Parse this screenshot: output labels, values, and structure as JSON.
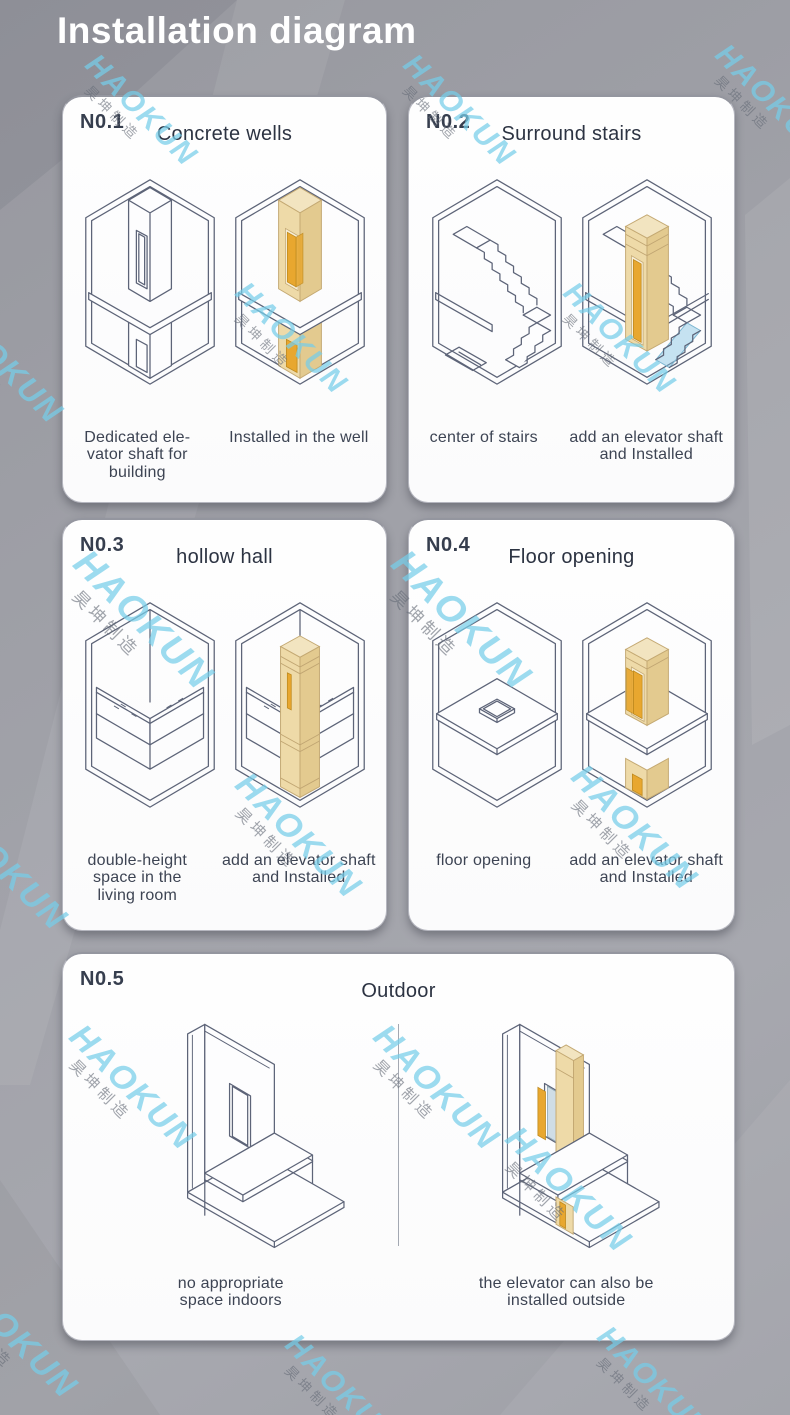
{
  "page": {
    "header_title": "Installation diagram"
  },
  "watermark": {
    "brand": "HAOKUN",
    "cn": "昊坤制造"
  },
  "colors": {
    "background": "#a0a1a8",
    "card": "#fdfdfe",
    "header_text": "#ffffff",
    "line": "#5d6478",
    "shaft_tan": "#eedaa8",
    "door_orange": "#e8a72f",
    "watermark_blue": "#76cde9"
  },
  "cards": [
    {
      "number": "N0.1",
      "title": "Concrete wells",
      "left_caption": "Dedicated ele-\nvator shaft for\nbuilding",
      "right_caption": "Installed in the well"
    },
    {
      "number": "N0.2",
      "title": "Surround stairs",
      "left_caption": "center of stairs",
      "right_caption": "add an elevator shaft\nand Installed"
    },
    {
      "number": "N0.3",
      "title": "hollow hall",
      "left_caption": "double-height\nspace in the\nliving room",
      "right_caption": "add an elevator shaft\nand Installed"
    },
    {
      "number": "N0.4",
      "title": "Floor opening",
      "left_caption": "floor opening",
      "right_caption": "add an elevator shaft\nand Installed"
    },
    {
      "number": "N0.5",
      "title": "Outdoor",
      "left_caption": "no appropriate\nspace indoors",
      "right_caption": "the elevator can also be\ninstalled outside"
    }
  ]
}
